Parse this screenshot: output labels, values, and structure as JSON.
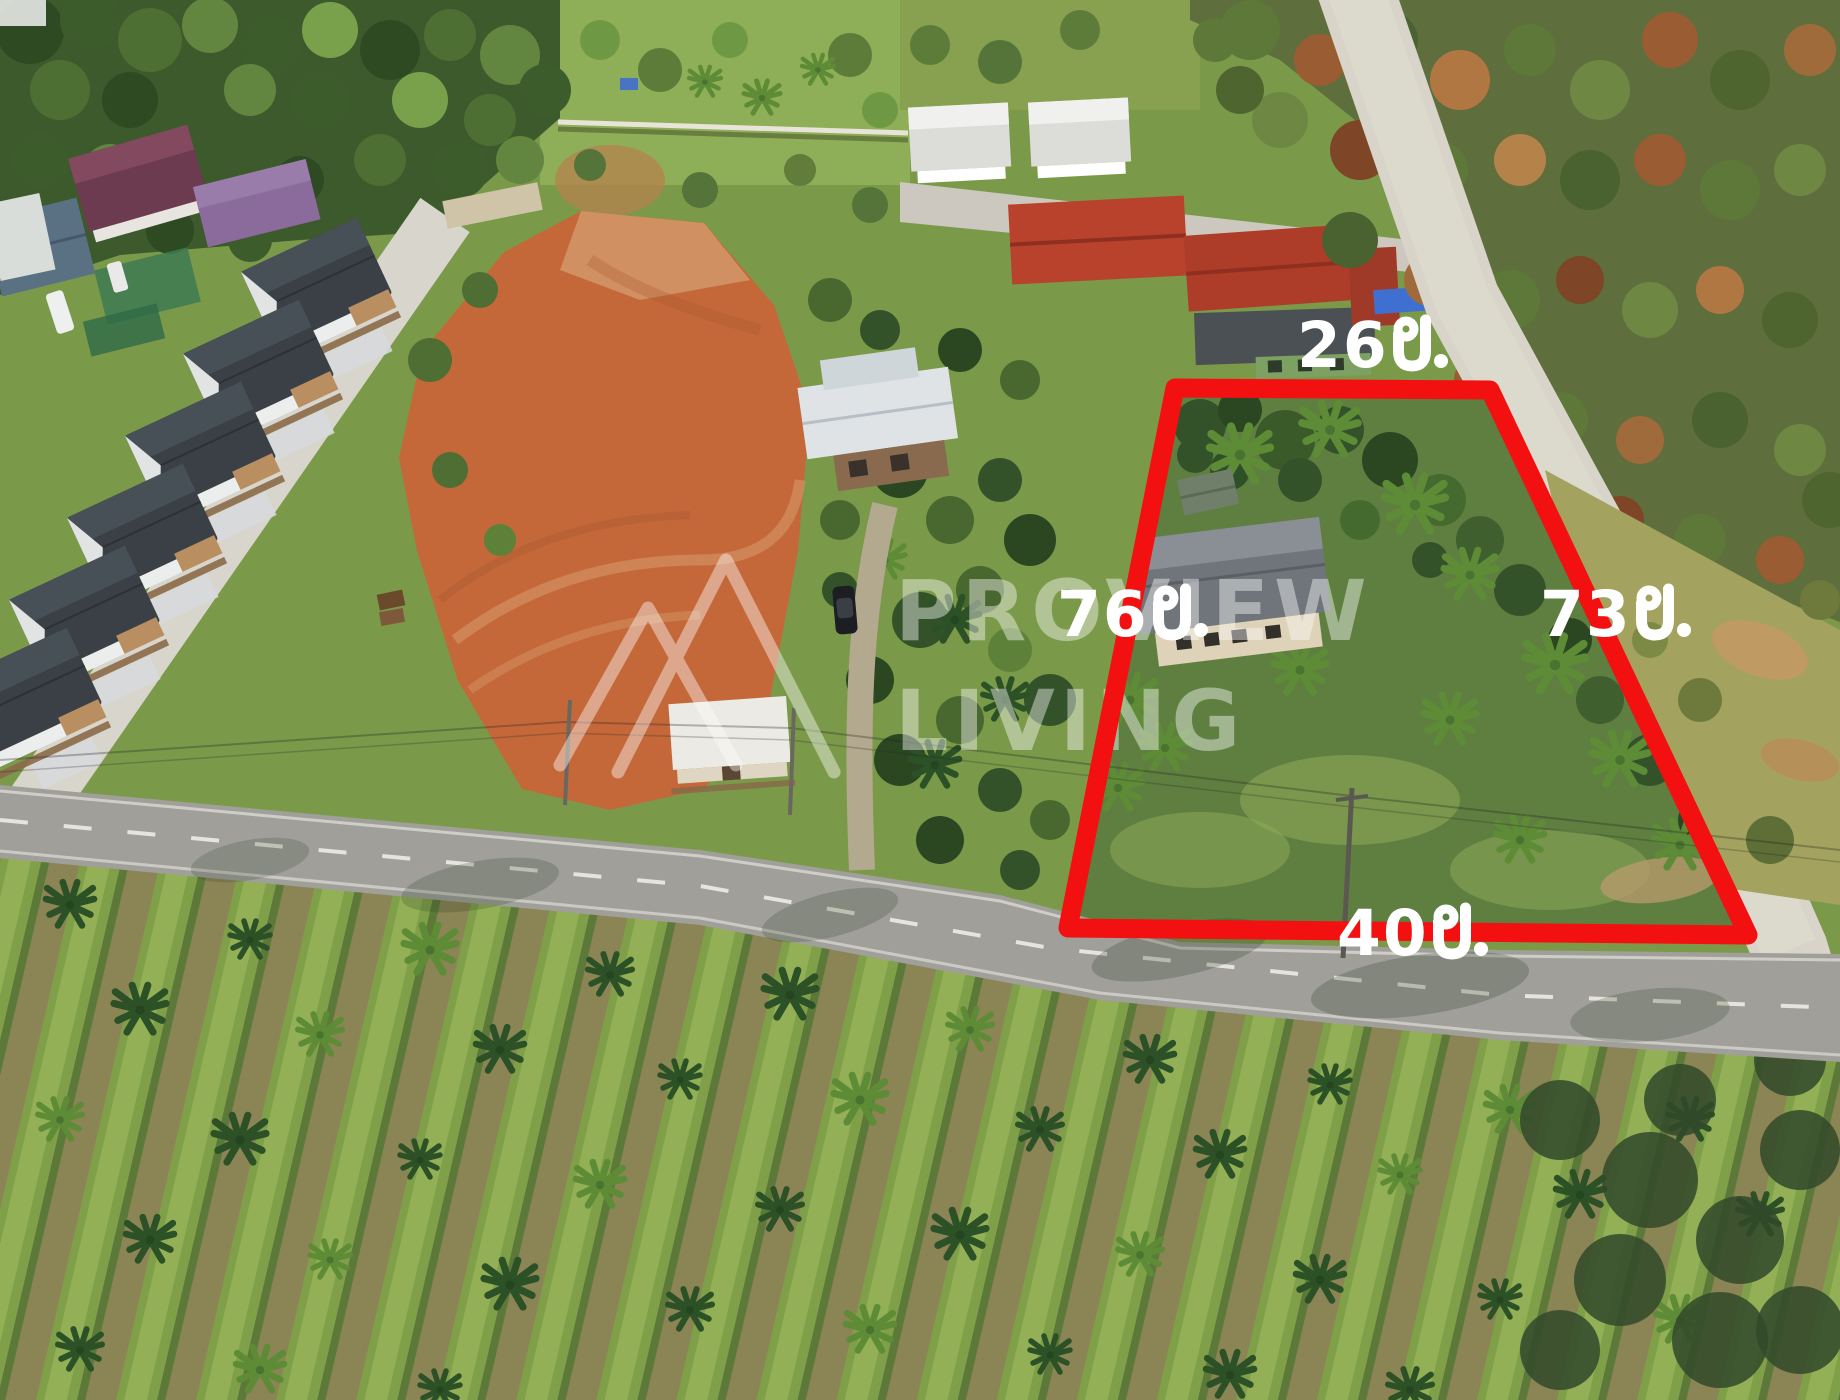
{
  "annotations": {
    "top_side": {
      "label": "26 ม.",
      "value": "26",
      "unit": "ม."
    },
    "left_side": {
      "label": "76 ม.",
      "value": "76",
      "unit": "ม."
    },
    "right_side": {
      "label": "73 ม.",
      "value": "73",
      "unit": "ม."
    },
    "bottom_side": {
      "label": "40 ม.",
      "value": "40",
      "unit": "ม."
    }
  },
  "watermark": {
    "line1": "PROVIEW",
    "line2": "LIVING"
  },
  "colors": {
    "plot_outline_red": "#f31010",
    "label_text_white": "#ffffff",
    "watermark_white": "rgba(255,255,255,0.42)",
    "road_asphalt": "#a09f9a",
    "road_concrete": "#d8d4c9",
    "cleared_dirt": "#c4683a"
  }
}
